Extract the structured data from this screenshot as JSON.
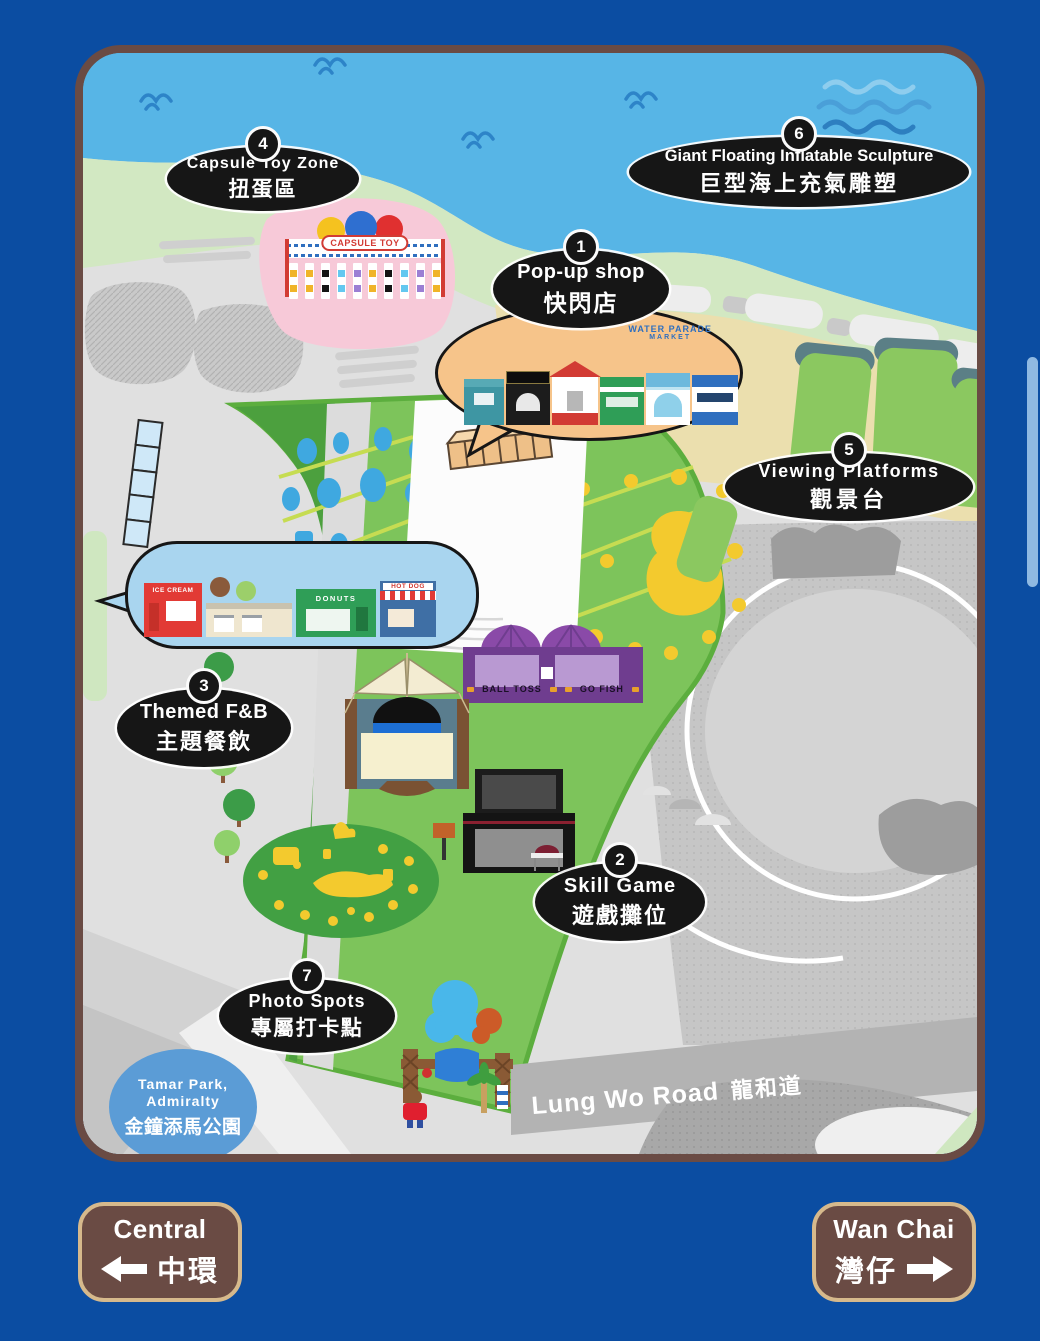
{
  "map": {
    "labels": [
      {
        "num": "1",
        "en": "Pop-up shop",
        "zh": "快閃店"
      },
      {
        "num": "2",
        "en": "Skill Game",
        "zh": "遊戲攤位"
      },
      {
        "num": "3",
        "en": "Themed F&B",
        "zh": "主題餐飲"
      },
      {
        "num": "4",
        "en": "Capsule Toy Zone",
        "zh": "扭蛋區"
      },
      {
        "num": "5",
        "en": "Viewing Platforms",
        "zh": "觀景台"
      },
      {
        "num": "6",
        "en": "Giant Floating Inflatable Sculpture",
        "zh": "巨型海上充氣雕塑"
      },
      {
        "num": "7",
        "en": "Photo Spots",
        "zh": "專屬打卡點"
      }
    ],
    "signs": {
      "capsule_toy": "CAPSULE TOY",
      "market_line1": "WATER PARADE",
      "market_line2": "MARKET",
      "ice_cream": "ICE CREAM",
      "donuts": "DONUTS",
      "hot_dog": "HOT DOG",
      "ball_toss": "BALL TOSS",
      "go_fish": "GO FISH"
    },
    "landmarks": {
      "tamar_line1": "Tamar Park,",
      "tamar_line2": "Admiralty",
      "tamar_zh": "金鐘添馬公園",
      "road_en": "Lung Wo Road",
      "road_zh": "龍和道"
    }
  },
  "nav": {
    "central": {
      "en": "Central",
      "zh": "中環"
    },
    "wan_chai": {
      "en": "Wan Chai",
      "zh": "灣仔"
    }
  },
  "colors": {
    "background": "#0b4da2",
    "map_border": "#6a4b44",
    "sea": "#57b5e6",
    "shore": "#d2e8c2",
    "sand": "#ebdfae",
    "lawn": "#7dc45b",
    "label_bg": "#161616",
    "bubble_orange": "#f6c48a",
    "bubble_blue": "#a9d5ef",
    "capsule_pink": "#f7c9d8",
    "booth_purple": "#6f3d8f",
    "tamar_blue": "#5b9cd6",
    "button_brown": "#6a4b44",
    "button_border": "#d6b98c",
    "scrollbar": "#8fb9e2"
  }
}
